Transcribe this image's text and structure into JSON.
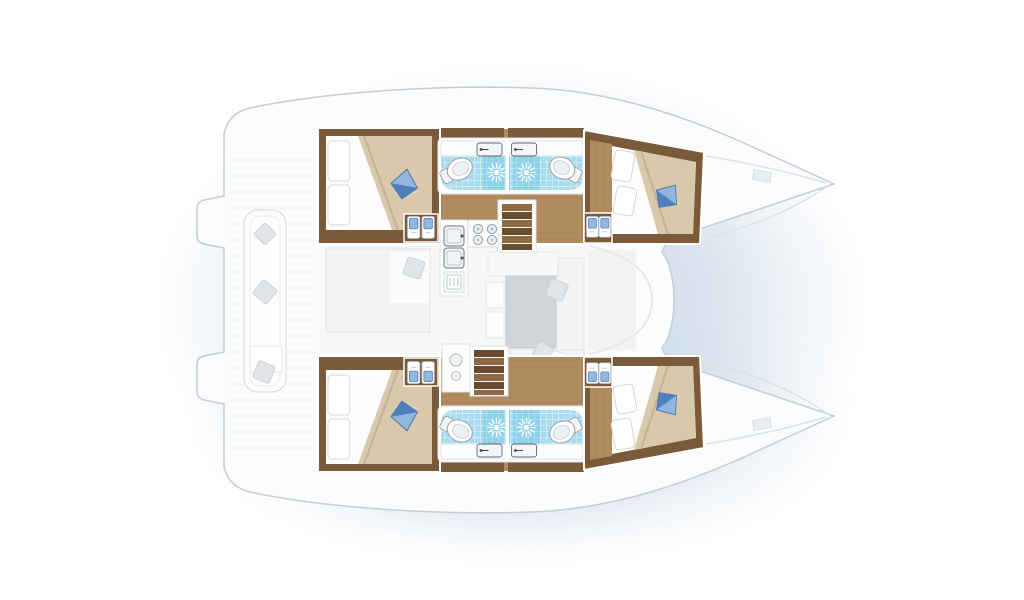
{
  "title": "Catamaran yacht interior layout floor plan, top-down view, bow to the right",
  "vessel": {
    "type": "catamaran",
    "view": "top-down floor plan",
    "orientation": "bow-right, stern-left",
    "hulls": 2
  },
  "inventory": {
    "double_berth_cabins": 4,
    "bathrooms": 4,
    "toilets": 4,
    "shower_drains": 4,
    "bathroom_sinks": 4,
    "wardrobe_lockers": 4,
    "towel_icons": 8,
    "companionway_stairs": 2,
    "galley_burners": 4,
    "galley_sinks": 2,
    "dining_tables": 1,
    "cockpit_benches": 1,
    "blue_accent_pillows": 4,
    "swim_platform_steps": 2
  },
  "colors": {
    "background": "#ffffff",
    "shadow": "#bfd0e2",
    "hull": "#fbfcfd",
    "hull_stroke": "#c6ccd2",
    "wood_floor": "#b18b60",
    "wood_plank": "#9c7850",
    "wood_dark": "#7a5a38",
    "step_light": "#8d6a42",
    "step_dark": "#674c2e",
    "tile": "#aadcef",
    "shower": "#8ed2ea",
    "bed_beige": "#d8c8ac",
    "bed_shadow": "#c2ae90",
    "linen_white": "#fdfdfd",
    "pillow_blue": "#4f7fbe",
    "pillow_blue_light": "#93b6de",
    "pillow_gray": "#e2e5e7",
    "table_gray": "#d2d5d7",
    "counter_white": "#fcfdfd",
    "fixture_stroke": "#99a1a8"
  }
}
